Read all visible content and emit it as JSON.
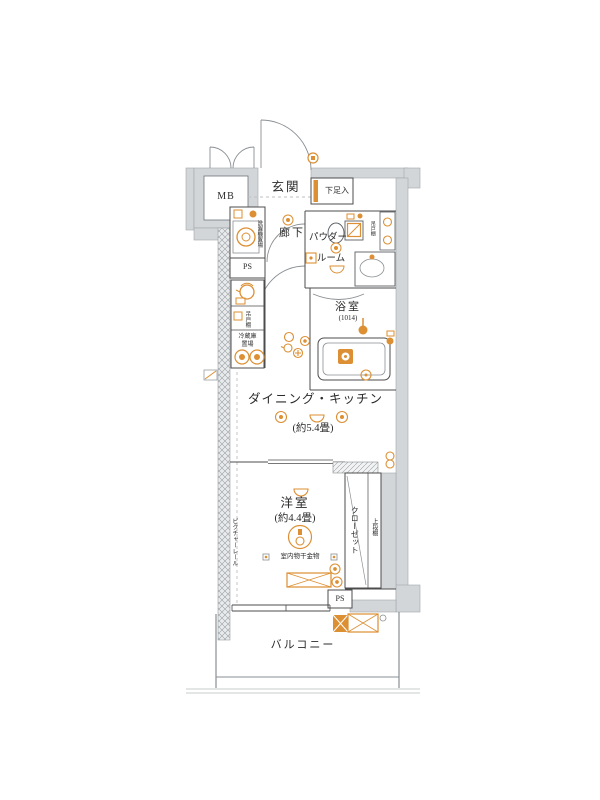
{
  "meta": {
    "type": "apartment-floorplan"
  },
  "colors": {
    "wall_fill": "#d3d6d9",
    "wall_stroke": "#a0a6aa",
    "partition_line": "#4c4c4c",
    "door_line": "#8a8f93",
    "accent_orange": "#dc8f33",
    "text": "#2b2b2b"
  },
  "labels": {
    "mb": "MB",
    "entrance": "玄関",
    "shoe_cabinet": "下足入",
    "hallway": "廊下",
    "powder_room_line1": "パウダー",
    "powder_room_line2": "ルーム",
    "bathroom": "浴室",
    "bathroom_size": "(1014)",
    "washing_machine": "洗濯機置場",
    "ps_upper": "PS",
    "hanging_cupboard_kitchen": "吊戸棚",
    "hanging_cupboard_powder": "吊戸棚",
    "fridge_line1": "冷蔵庫",
    "fridge_line2": "置場",
    "dining_kitchen": "ダイニング・キッチン",
    "dining_kitchen_size": "(約5.4畳)",
    "western_room": "洋室",
    "western_room_size": "(約4.4畳)",
    "indoor_drying": "室内物干金物",
    "closet": "クローゼット",
    "upper_shelf": "上段棚",
    "picture_rail": "ピクチャーレール",
    "ps_lower": "PS",
    "balcony": "バルコニー"
  }
}
